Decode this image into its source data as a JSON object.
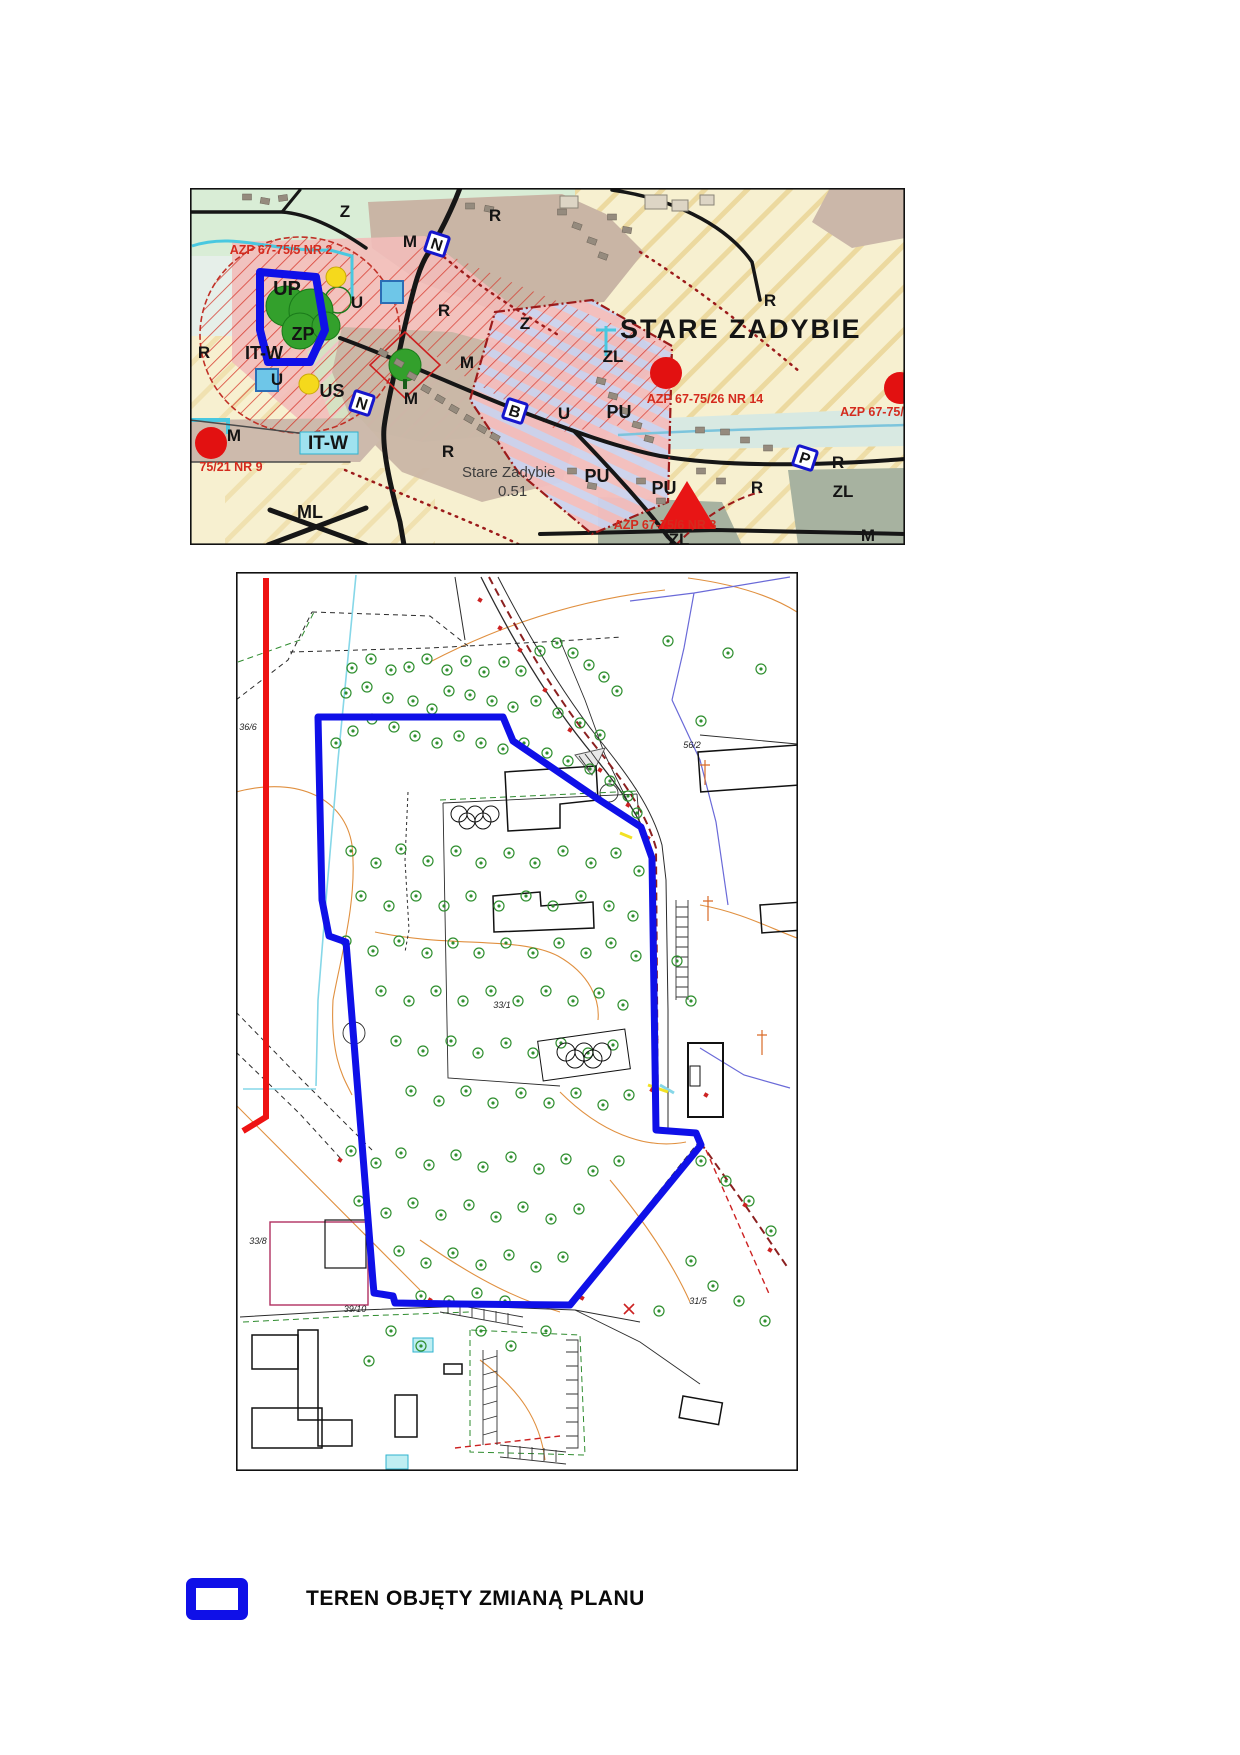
{
  "page": {
    "width": 1240,
    "height": 1755,
    "background": "#ffffff"
  },
  "palette": {
    "boundary_blue": "#0f10e8",
    "red_line": "#ee1212",
    "tree_green": "#2f8f2f",
    "cream": "#f7f0d0",
    "stripe_tan": "#ead596",
    "zone_green": "#d9edd6",
    "zone_brown": "#c9b5a5",
    "zone_pink": "#f2bcba",
    "zone_mint": "#cfe9c5",
    "zone_zl": "#a7b2a0",
    "hatch_red": "#d63226",
    "azp_red": "#d42b1e",
    "road_black": "#161616"
  },
  "top_map": {
    "name": "zoning-plan-overview-map",
    "title": "STARE ZADYBIE",
    "subtitle": "Stare Zadybie",
    "subtitle_value": "0.51",
    "zone_labels": [
      {
        "x": 345,
        "y": 217,
        "t": "Z"
      },
      {
        "x": 495,
        "y": 221,
        "t": "R"
      },
      {
        "x": 410,
        "y": 247,
        "t": "M"
      },
      {
        "x": 770,
        "y": 306,
        "t": "R"
      },
      {
        "x": 287,
        "y": 295,
        "t": "UP",
        "s": 20
      },
      {
        "x": 357,
        "y": 308,
        "t": "U"
      },
      {
        "x": 303,
        "y": 340,
        "t": "ZP",
        "s": 18
      },
      {
        "x": 204,
        "y": 358,
        "t": "R"
      },
      {
        "x": 264,
        "y": 359,
        "t": "IT-W",
        "s": 18
      },
      {
        "x": 277,
        "y": 385,
        "t": "U"
      },
      {
        "x": 332,
        "y": 397,
        "t": "US",
        "s": 18
      },
      {
        "x": 467,
        "y": 368,
        "t": "M"
      },
      {
        "x": 444,
        "y": 316,
        "t": "R"
      },
      {
        "x": 525,
        "y": 329,
        "t": "Z"
      },
      {
        "x": 411,
        "y": 404,
        "t": "M"
      },
      {
        "x": 234,
        "y": 441,
        "t": "M"
      },
      {
        "x": 328,
        "y": 449,
        "t": "IT-W",
        "s": 19
      },
      {
        "x": 448,
        "y": 457,
        "t": "R"
      },
      {
        "x": 613,
        "y": 362,
        "t": "ZL"
      },
      {
        "x": 564,
        "y": 419,
        "t": "U"
      },
      {
        "x": 619,
        "y": 418,
        "t": "PU",
        "s": 18
      },
      {
        "x": 597,
        "y": 482,
        "t": "PU",
        "s": 18
      },
      {
        "x": 664,
        "y": 494,
        "t": "PU",
        "s": 18
      },
      {
        "x": 757,
        "y": 493,
        "t": "R"
      },
      {
        "x": 679,
        "y": 545,
        "t": "ZL"
      },
      {
        "x": 310,
        "y": 518,
        "t": "ML",
        "s": 18
      },
      {
        "x": 838,
        "y": 468,
        "t": "R"
      },
      {
        "x": 843,
        "y": 497,
        "t": "ZL"
      },
      {
        "x": 868,
        "y": 541,
        "t": "M"
      }
    ],
    "azp_labels": [
      {
        "x": 281,
        "y": 254,
        "t": "AZP 67-75/5 NR 2"
      },
      {
        "x": 705,
        "y": 403,
        "t": "AZP 67-75/26 NR 14"
      },
      {
        "x": 872,
        "y": 416,
        "t": "AZP 67-75/"
      },
      {
        "x": 665,
        "y": 529,
        "t": "AZP 67-75/6 NR 3"
      },
      {
        "x": 231,
        "y": 471,
        "t": "75/21 NR 9"
      }
    ],
    "icons": {
      "red_circles": [
        [
          211,
          443
        ],
        [
          666,
          373
        ],
        [
          900,
          388
        ]
      ],
      "red_triangle": {
        "cx": 687,
        "cy": 505,
        "w": 58,
        "h": 48
      },
      "blue_letter_squares": [
        {
          "x": 437,
          "y": 244,
          "l": "N"
        },
        {
          "x": 362,
          "y": 403,
          "l": "N"
        },
        {
          "x": 515,
          "y": 411,
          "l": "B"
        },
        {
          "x": 805,
          "y": 458,
          "l": "P"
        }
      ],
      "cyan_squares": [
        [
          392,
          292
        ],
        [
          267,
          380
        ]
      ],
      "yellow_circles": [
        [
          336,
          277
        ],
        [
          309,
          384
        ]
      ]
    },
    "buildings": [
      [
        247,
        197,
        0
      ],
      [
        265,
        201,
        10
      ],
      [
        283,
        198,
        -8
      ],
      [
        470,
        206,
        0
      ],
      [
        489,
        209,
        12
      ],
      [
        562,
        212,
        0
      ],
      [
        577,
        226,
        20
      ],
      [
        592,
        241,
        20
      ],
      [
        603,
        256,
        20
      ],
      [
        612,
        217,
        0
      ],
      [
        627,
        230,
        10
      ],
      [
        383,
        353,
        30
      ],
      [
        399,
        363,
        30
      ],
      [
        412,
        376,
        30
      ],
      [
        426,
        389,
        30
      ],
      [
        440,
        399,
        30
      ],
      [
        454,
        409,
        30
      ],
      [
        469,
        419,
        30
      ],
      [
        482,
        429,
        30
      ],
      [
        495,
        437,
        30
      ],
      [
        601,
        381,
        15
      ],
      [
        613,
        396,
        15
      ],
      [
        625,
        411,
        15
      ],
      [
        637,
        425,
        15
      ],
      [
        649,
        439,
        15
      ],
      [
        572,
        471,
        0
      ],
      [
        592,
        486,
        10
      ],
      [
        641,
        481,
        0
      ],
      [
        661,
        501,
        0
      ],
      [
        701,
        471,
        0
      ],
      [
        721,
        481,
        0
      ],
      [
        745,
        440,
        0
      ],
      [
        768,
        448,
        0
      ],
      [
        700,
        430,
        0
      ],
      [
        725,
        432,
        0
      ]
    ]
  },
  "bottom_map": {
    "name": "survey-base-map",
    "boundary_polygon": [
      [
        318,
        717
      ],
      [
        503,
        717
      ],
      [
        513,
        741
      ],
      [
        598,
        799
      ],
      [
        641,
        827
      ],
      [
        652,
        858
      ],
      [
        656,
        1130
      ],
      [
        696,
        1133
      ],
      [
        701,
        1145
      ],
      [
        570,
        1305
      ],
      [
        458,
        1304
      ],
      [
        395,
        1303
      ],
      [
        393,
        1296
      ],
      [
        374,
        1293
      ],
      [
        373,
        1282
      ],
      [
        346,
        942
      ],
      [
        329,
        936
      ],
      [
        322,
        900
      ]
    ],
    "red_line": [
      [
        266,
        578
      ],
      [
        266,
        1117
      ],
      [
        243,
        1131
      ]
    ],
    "olympic_rings": [
      {
        "cx": 475,
        "cy": 817,
        "r": 8,
        "boxed": false
      },
      {
        "cx": 584,
        "cy": 1055,
        "r": 9,
        "boxed": true
      }
    ],
    "parcel_labels": [
      {
        "x": 692,
        "y": 748,
        "t": "56/2"
      },
      {
        "x": 248,
        "y": 730,
        "t": "36/6"
      },
      {
        "x": 355,
        "y": 1312,
        "t": "39/10"
      },
      {
        "x": 698,
        "y": 1304,
        "t": "31/5"
      },
      {
        "x": 502,
        "y": 1008,
        "t": "33/1"
      },
      {
        "x": 258,
        "y": 1244,
        "t": "33/8"
      }
    ],
    "red_marks": [
      [
        520,
        650
      ],
      [
        545,
        690
      ],
      [
        570,
        730
      ],
      [
        600,
        770
      ],
      [
        628,
        805
      ],
      [
        648,
        838
      ],
      [
        652,
        1090
      ],
      [
        700,
        1142
      ],
      [
        582,
        1298
      ],
      [
        658,
        1130
      ],
      [
        706,
        1095
      ],
      [
        480,
        600
      ],
      [
        500,
        628
      ],
      [
        745,
        1205
      ],
      [
        770,
        1250
      ],
      [
        655,
        940
      ],
      [
        655,
        990
      ],
      [
        656,
        1040
      ],
      [
        340,
        1160
      ],
      [
        430,
        1300
      ]
    ],
    "trees": [
      [
        352,
        668
      ],
      [
        371,
        659
      ],
      [
        391,
        670
      ],
      [
        346,
        693
      ],
      [
        367,
        687
      ],
      [
        388,
        698
      ],
      [
        409,
        667
      ],
      [
        427,
        659
      ],
      [
        447,
        670
      ],
      [
        466,
        661
      ],
      [
        484,
        672
      ],
      [
        504,
        662
      ],
      [
        521,
        671
      ],
      [
        540,
        651
      ],
      [
        557,
        643
      ],
      [
        573,
        653
      ],
      [
        589,
        665
      ],
      [
        604,
        677
      ],
      [
        617,
        691
      ],
      [
        449,
        691
      ],
      [
        470,
        695
      ],
      [
        492,
        701
      ],
      [
        513,
        707
      ],
      [
        536,
        701
      ],
      [
        558,
        713
      ],
      [
        580,
        723
      ],
      [
        600,
        735
      ],
      [
        413,
        701
      ],
      [
        432,
        709
      ],
      [
        372,
        719
      ],
      [
        394,
        727
      ],
      [
        353,
        731
      ],
      [
        336,
        743
      ],
      [
        415,
        736
      ],
      [
        437,
        743
      ],
      [
        459,
        736
      ],
      [
        481,
        743
      ],
      [
        503,
        749
      ],
      [
        524,
        743
      ],
      [
        547,
        753
      ],
      [
        568,
        761
      ],
      [
        590,
        769
      ],
      [
        610,
        781
      ],
      [
        628,
        796
      ],
      [
        637,
        813
      ],
      [
        351,
        851
      ],
      [
        376,
        863
      ],
      [
        401,
        849
      ],
      [
        428,
        861
      ],
      [
        456,
        851
      ],
      [
        481,
        863
      ],
      [
        509,
        853
      ],
      [
        535,
        863
      ],
      [
        563,
        851
      ],
      [
        591,
        863
      ],
      [
        616,
        853
      ],
      [
        639,
        871
      ],
      [
        361,
        896
      ],
      [
        389,
        906
      ],
      [
        416,
        896
      ],
      [
        444,
        906
      ],
      [
        471,
        896
      ],
      [
        499,
        906
      ],
      [
        526,
        896
      ],
      [
        553,
        906
      ],
      [
        581,
        896
      ],
      [
        609,
        906
      ],
      [
        633,
        916
      ],
      [
        346,
        941
      ],
      [
        373,
        951
      ],
      [
        399,
        941
      ],
      [
        427,
        953
      ],
      [
        453,
        943
      ],
      [
        479,
        953
      ],
      [
        506,
        943
      ],
      [
        533,
        953
      ],
      [
        559,
        943
      ],
      [
        586,
        953
      ],
      [
        611,
        943
      ],
      [
        636,
        956
      ],
      [
        381,
        991
      ],
      [
        409,
        1001
      ],
      [
        436,
        991
      ],
      [
        463,
        1001
      ],
      [
        491,
        991
      ],
      [
        518,
        1001
      ],
      [
        546,
        991
      ],
      [
        573,
        1001
      ],
      [
        599,
        993
      ],
      [
        623,
        1005
      ],
      [
        396,
        1041
      ],
      [
        423,
        1051
      ],
      [
        451,
        1041
      ],
      [
        478,
        1053
      ],
      [
        506,
        1043
      ],
      [
        533,
        1053
      ],
      [
        561,
        1043
      ],
      [
        588,
        1053
      ],
      [
        613,
        1045
      ],
      [
        411,
        1091
      ],
      [
        439,
        1101
      ],
      [
        466,
        1091
      ],
      [
        493,
        1103
      ],
      [
        521,
        1093
      ],
      [
        549,
        1103
      ],
      [
        576,
        1093
      ],
      [
        603,
        1105
      ],
      [
        629,
        1095
      ],
      [
        351,
        1151
      ],
      [
        376,
        1163
      ],
      [
        401,
        1153
      ],
      [
        429,
        1165
      ],
      [
        456,
        1155
      ],
      [
        483,
        1167
      ],
      [
        511,
        1157
      ],
      [
        539,
        1169
      ],
      [
        566,
        1159
      ],
      [
        593,
        1171
      ],
      [
        619,
        1161
      ],
      [
        359,
        1201
      ],
      [
        386,
        1213
      ],
      [
        413,
        1203
      ],
      [
        441,
        1215
      ],
      [
        469,
        1205
      ],
      [
        496,
        1217
      ],
      [
        523,
        1207
      ],
      [
        551,
        1219
      ],
      [
        579,
        1209
      ],
      [
        399,
        1251
      ],
      [
        426,
        1263
      ],
      [
        453,
        1253
      ],
      [
        481,
        1265
      ],
      [
        509,
        1255
      ],
      [
        536,
        1267
      ],
      [
        563,
        1257
      ],
      [
        421,
        1296
      ],
      [
        449,
        1301
      ],
      [
        477,
        1293
      ],
      [
        505,
        1301
      ],
      [
        668,
        641
      ],
      [
        728,
        653
      ],
      [
        761,
        669
      ],
      [
        701,
        721
      ],
      [
        677,
        961
      ],
      [
        691,
        1001
      ],
      [
        701,
        1161
      ],
      [
        726,
        1181
      ],
      [
        749,
        1201
      ],
      [
        771,
        1231
      ],
      [
        691,
        1261
      ],
      [
        713,
        1286
      ],
      [
        739,
        1301
      ],
      [
        765,
        1321
      ],
      [
        659,
        1311
      ],
      [
        391,
        1331
      ],
      [
        421,
        1346
      ],
      [
        369,
        1361
      ],
      [
        481,
        1331
      ],
      [
        511,
        1346
      ],
      [
        546,
        1331
      ]
    ]
  },
  "legend": {
    "items": [
      {
        "symbol": "blue-rect-outline",
        "color": "#0f10e8",
        "label": "TEREN OBJĘTY ZMIANĄ PLANU"
      }
    ]
  }
}
